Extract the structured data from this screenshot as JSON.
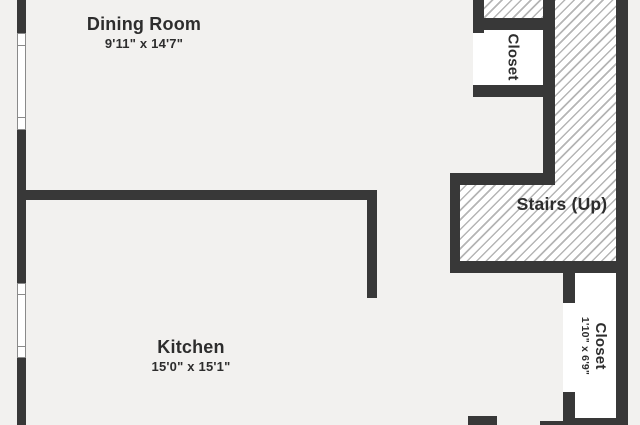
{
  "floorplan": {
    "colors": {
      "wall": "#383838",
      "floor": "#f2f1ef",
      "room_fill": "#ffffff",
      "hatch_line": "#b5b5b5",
      "window_frame": "#8a8a8a",
      "text": "#2d2d2d"
    },
    "rooms": {
      "dining": {
        "name": "Dining Room",
        "dims": "9'11\" x 14'7\""
      },
      "kitchen": {
        "name": "Kitchen",
        "dims": "15'0\" x 15'1\""
      },
      "upper_closet": {
        "name": "Closet"
      },
      "stairs": {
        "name": "Stairs (Up)"
      },
      "lower_closet": {
        "name": "Closet",
        "dims": "1'10\" x 6'9\""
      }
    }
  }
}
